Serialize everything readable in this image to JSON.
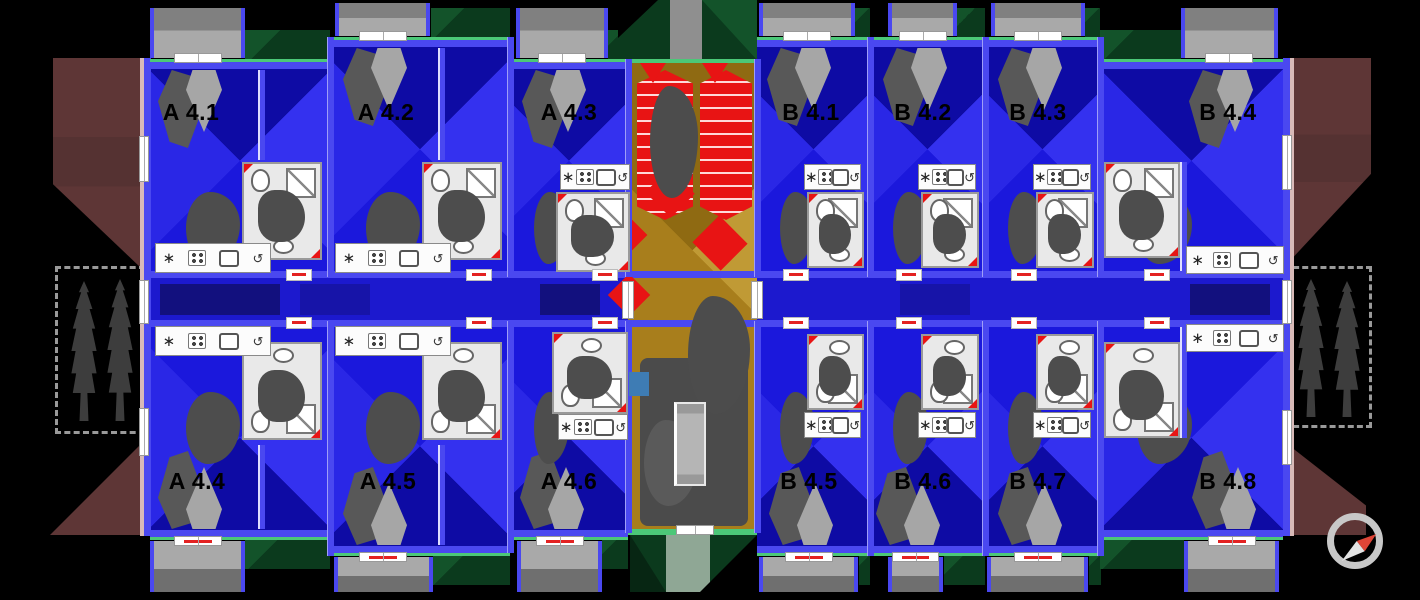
{
  "scene": {
    "type": "apartment-building-floor-plan",
    "view": "top-down"
  },
  "units": [
    {
      "label": "A 4.1",
      "x": 150,
      "w": 180,
      "row": "top",
      "y_out": 62,
      "lx": 0.23,
      "type": "A",
      "bfx": 0.0,
      "bfw": 0.53
    },
    {
      "label": "A 4.2",
      "x": 330,
      "w": 180,
      "row": "top",
      "y_out": 40,
      "lx": 0.31,
      "type": "A",
      "bfx": 0.03,
      "bfw": 0.53
    },
    {
      "label": "A 4.3",
      "x": 510,
      "w": 118,
      "row": "top",
      "y_out": 62,
      "lx": 0.5,
      "type": "C",
      "bfx": 0.05,
      "bfw": 0.78
    },
    {
      "label": "B 4.1",
      "x": 757,
      "w": 113,
      "row": "top",
      "y_out": 40,
      "lx": 0.48,
      "type": "B",
      "bfx": 0.02,
      "bfw": 0.85
    },
    {
      "label": "B 4.2",
      "x": 870,
      "w": 115,
      "row": "top",
      "y_out": 40,
      "lx": 0.46,
      "type": "B",
      "bfx": 0.16,
      "bfw": 0.6
    },
    {
      "label": "B 4.3",
      "x": 985,
      "w": 115,
      "row": "top",
      "y_out": 40,
      "lx": 0.46,
      "type": "B",
      "bfx": 0.05,
      "bfw": 0.82
    },
    {
      "label": "B 4.4",
      "x": 1100,
      "w": 183,
      "row": "top",
      "y_out": 62,
      "lx": 0.7,
      "type": "BL",
      "bfx": 0.44,
      "bfw": 0.53
    },
    {
      "label": "A 4.4",
      "x": 150,
      "w": 180,
      "row": "bottom",
      "y_out": 537,
      "lx": 0.26,
      "type": "A",
      "bfx": 0.0,
      "bfw": 0.53
    },
    {
      "label": "A 4.5",
      "x": 330,
      "w": 180,
      "row": "bottom",
      "y_out": 553,
      "lx": 0.32,
      "type": "A",
      "bfx": 0.02,
      "bfw": 0.55
    },
    {
      "label": "A 4.6",
      "x": 510,
      "w": 118,
      "row": "bottom",
      "y_out": 537,
      "lx": 0.5,
      "type": "C",
      "bfx": 0.06,
      "bfw": 0.72
    },
    {
      "label": "B 4.5",
      "x": 757,
      "w": 113,
      "row": "bottom",
      "y_out": 553,
      "lx": 0.46,
      "type": "B",
      "bfx": 0.02,
      "bfw": 0.88
    },
    {
      "label": "B 4.6",
      "x": 870,
      "w": 115,
      "row": "bottom",
      "y_out": 553,
      "lx": 0.46,
      "type": "B",
      "bfx": 0.16,
      "bfw": 0.48
    },
    {
      "label": "B 4.7",
      "x": 985,
      "w": 115,
      "row": "bottom",
      "y_out": 553,
      "lx": 0.46,
      "type": "B",
      "bfx": 0.02,
      "bfw": 0.88
    },
    {
      "label": "B 4.8",
      "x": 1100,
      "w": 183,
      "row": "bottom",
      "y_out": 537,
      "lx": 0.7,
      "type": "BL",
      "bfx": 0.46,
      "bfw": 0.52
    }
  ],
  "icons": {
    "radiator": "∗",
    "extractor": "↺",
    "compass_needle_direction": "north-east"
  },
  "colors": {
    "bg": "#000000",
    "blue-base": "#1b18dc",
    "blue-light": "#3431ef",
    "blue-light2": "#2a27e6",
    "blue-dark": "#0e0ba4",
    "wall-blue": "#4a48f0",
    "corridor": "#1c19ce",
    "corridor-dark": "#12107e",
    "facade-green": "#4cc878",
    "roof-green": "#0b3a1d",
    "roof-green-light": "#13532a",
    "sage": "#8fa795",
    "tan": "#a87e1c",
    "tan-light": "#c09a35",
    "red": "#e81414",
    "maroon": "#5e3636",
    "balcony-dark": "#808080",
    "balcony-light": "#a9a9a9",
    "balcony-dark2": "#6f6f6f",
    "blob": "#4d4d4d",
    "curtain": "#a6a6a6",
    "curtain-dark": "#585858",
    "tree": "#3d3d3d",
    "ring": "#c8c8c8",
    "needle-red": "#de4537",
    "needle-white": "#e3e3e3",
    "pink": "#d8bab8",
    "steel": "#3e7cb4"
  }
}
